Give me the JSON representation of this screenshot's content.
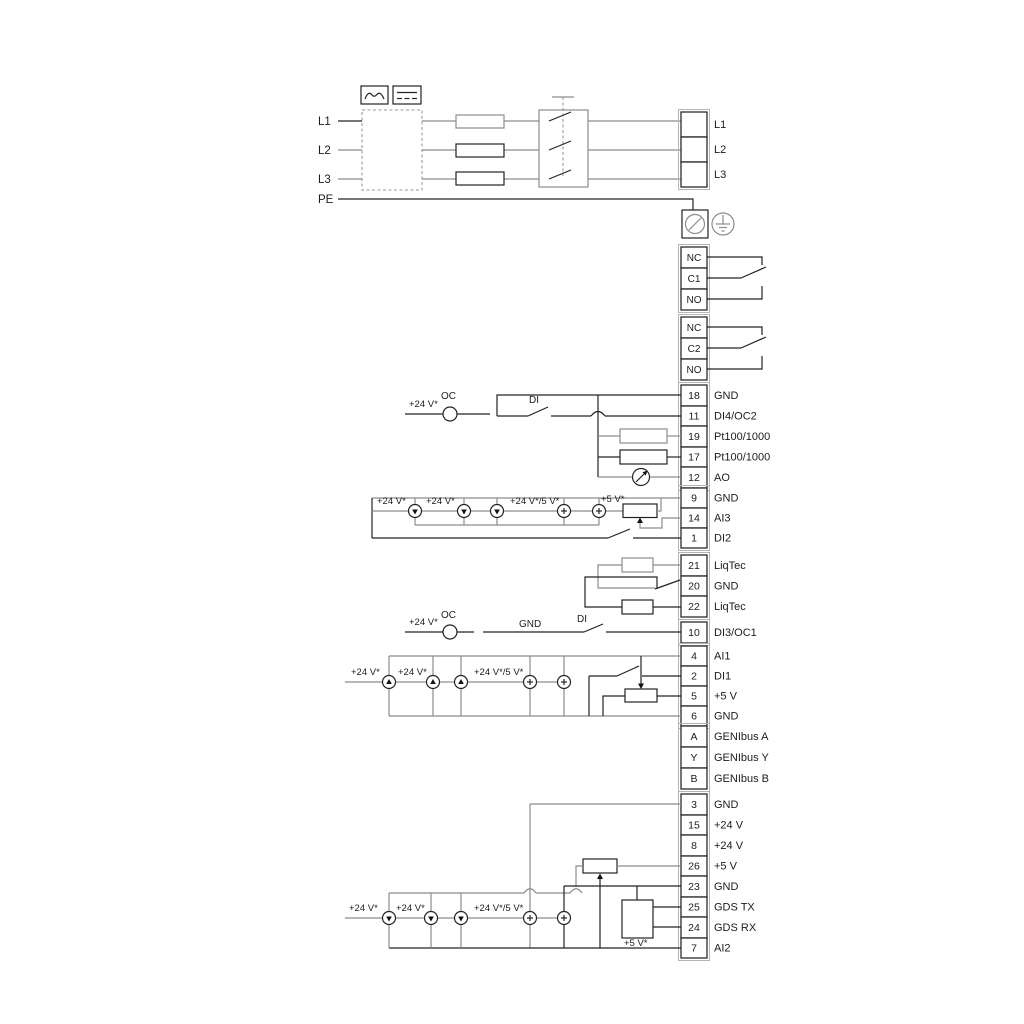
{
  "mains": {
    "inputs": [
      "L1",
      "L2",
      "L3",
      "PE"
    ],
    "outputs": [
      "L1",
      "L2",
      "L3"
    ]
  },
  "relay1": [
    "NC",
    "C1",
    "NO"
  ],
  "relay2": [
    "NC",
    "C2",
    "NO"
  ],
  "groupA": [
    {
      "num": "18",
      "label": "GND"
    },
    {
      "num": "11",
      "label": "DI4/OC2"
    },
    {
      "num": "19",
      "label": "Pt100/1000"
    },
    {
      "num": "17",
      "label": "Pt100/1000"
    },
    {
      "num": "12",
      "label": "AO"
    }
  ],
  "groupB": [
    {
      "num": "9",
      "label": "GND"
    },
    {
      "num": "14",
      "label": "AI3"
    },
    {
      "num": "1",
      "label": "DI2"
    }
  ],
  "liqtec": [
    {
      "num": "21",
      "label": "LiqTec"
    },
    {
      "num": "20",
      "label": "GND"
    },
    {
      "num": "22",
      "label": "LiqTec"
    }
  ],
  "di3": {
    "num": "10",
    "label": "DI3/OC1"
  },
  "groupC": [
    {
      "num": "4",
      "label": "AI1"
    },
    {
      "num": "2",
      "label": "DI1"
    },
    {
      "num": "5",
      "label": "+5 V"
    },
    {
      "num": "6",
      "label": "GND"
    }
  ],
  "genibus": [
    {
      "num": "A",
      "label": "GENIbus A"
    },
    {
      "num": "Y",
      "label": "GENIbus Y"
    },
    {
      "num": "B",
      "label": "GENIbus B"
    }
  ],
  "groupD": [
    {
      "num": "3",
      "label": "GND"
    },
    {
      "num": "15",
      "label": "+24 V"
    },
    {
      "num": "8",
      "label": "+24 V"
    },
    {
      "num": "26",
      "label": "+5 V"
    },
    {
      "num": "23",
      "label": "GND"
    },
    {
      "num": "25",
      "label": "GDS TX"
    },
    {
      "num": "24",
      "label": "GDS RX"
    },
    {
      "num": "7",
      "label": "AI2"
    }
  ],
  "ann": {
    "oc2": {
      "v24": "+24 V*",
      "oc": "OC",
      "di": "DI"
    },
    "ai3": {
      "v24a": "+24 V*",
      "v24b": "+24 V*",
      "v245": "+24 V*/5 V*",
      "v5": "+5 V*"
    },
    "di3": {
      "v24": "+24 V*",
      "oc": "OC",
      "gnd": "GND",
      "di": "DI"
    },
    "ai1": {
      "v24a": "+24 V*",
      "v24b": "+24 V*",
      "v245": "+24 V*/5 V*"
    },
    "ai2": {
      "v24a": "+24 V*",
      "v24b": "+24 V*",
      "v245": "+24 V*/5 V*",
      "v5": "+5 V*"
    }
  },
  "colors": {
    "wire_gray": "#8c8c8c",
    "ink": "#1f1f1f",
    "background": "#ffffff"
  }
}
